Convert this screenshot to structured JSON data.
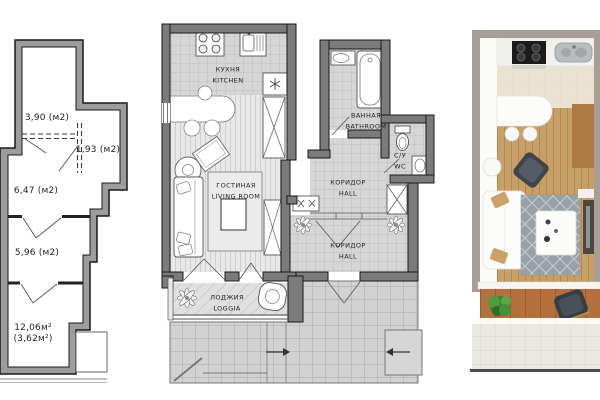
{
  "title": "Apartment floor plans (schematic, detailed, 3D render)",
  "left_plan": {
    "description": "schematic plan with room areas",
    "room_areas": [
      "3,90 (м2)",
      "1,93 (м2)",
      "6,47 (м2)",
      "5,96 (м2)",
      "12,06м²",
      "(3,62м²)"
    ]
  },
  "detailed_plan": {
    "rooms": [
      {
        "ru": "КУХНЯ",
        "en": "KITCHEN"
      },
      {
        "ru": "ГОСТИНАЯ",
        "en": "LIVING ROOM"
      },
      {
        "ru": "ВАННАЯ",
        "en": "BATHROOM"
      },
      {
        "ru": "С/У",
        "en": "WC"
      },
      {
        "ru": "КОРИДОР",
        "en": "HALL"
      },
      {
        "ru": "КОРИДОР",
        "en": "HALL"
      },
      {
        "ru": "ЛОДЖИЯ",
        "en": "LOGGIA"
      }
    ]
  },
  "colors": {
    "plan_wall_dark": "#7b7b7b",
    "plan_wall_light": "#9c9c9c",
    "tile_gray": "#d6d6d6",
    "render_wall": "#a89e99",
    "wood_floor": "#c79f69",
    "loggia_wood": "#b4713d",
    "rug_gray": "#9aa0a8",
    "plant_green": "#3d8430"
  }
}
